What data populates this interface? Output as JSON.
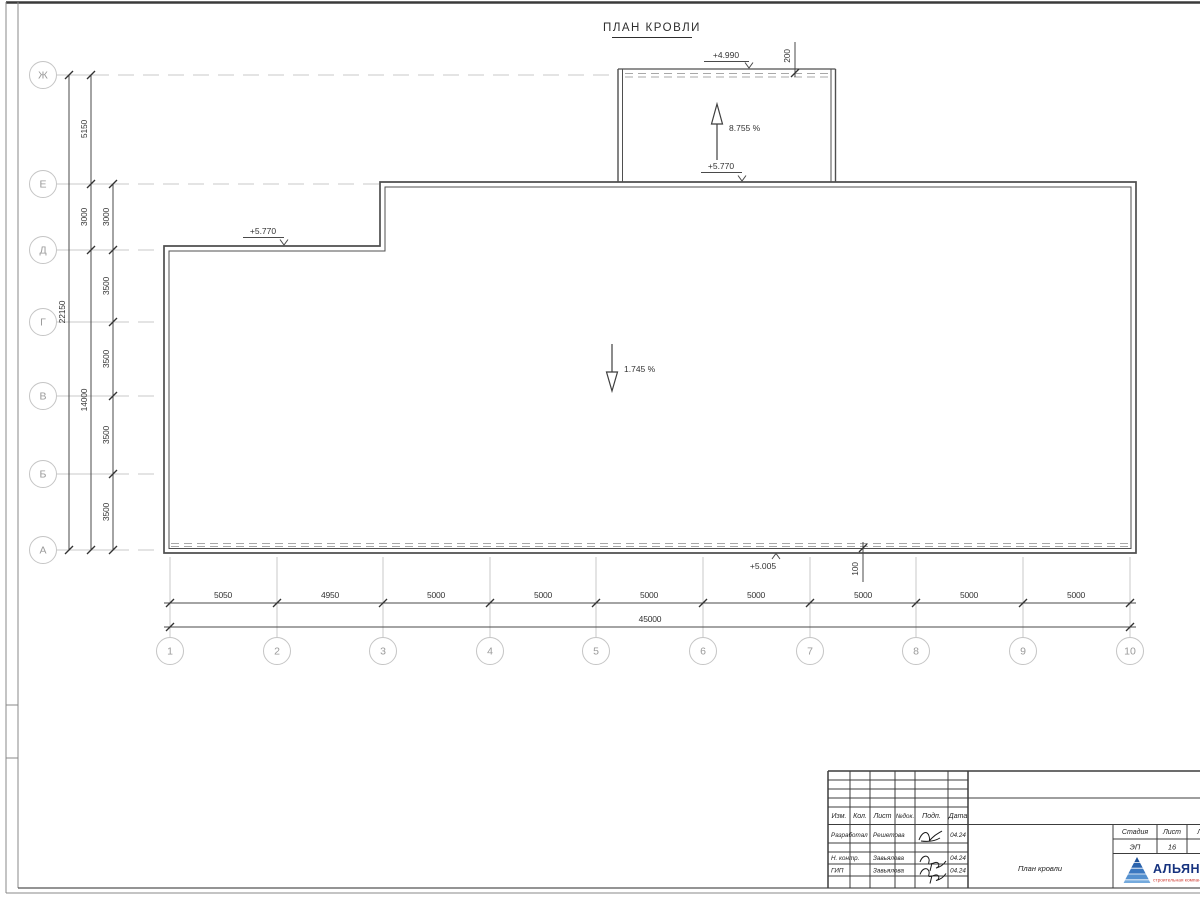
{
  "title": "ПЛАН КРОВЛИ",
  "axis": {
    "rows": [
      "Ж",
      "Е",
      "Д",
      "Г",
      "В",
      "Б",
      "А"
    ],
    "cols": [
      "1",
      "2",
      "3",
      "4",
      "5",
      "6",
      "7",
      "8",
      "9",
      "10"
    ]
  },
  "dims": {
    "bottom": [
      "5050",
      "4950",
      "5000",
      "5000",
      "5000",
      "5000",
      "5000",
      "5000",
      "5000"
    ],
    "bottom_total": "45000",
    "left_total": "22150",
    "left_mid": [
      "5150",
      "3000",
      "14000"
    ],
    "left_inner": [
      "3000",
      "3500",
      "3500",
      "3500",
      "3500"
    ],
    "parapet_top": "200",
    "parapet_bottom": "100"
  },
  "marks": {
    "elev_block_top": "+4.990",
    "elev_block_base": "+5.770",
    "elev_roof_left": "+5.770",
    "elev_roof_bottom": "+5.005",
    "slope_block": "8.755 %",
    "slope_roof": "1.745 %"
  },
  "titleblock": {
    "cols": [
      "Изм.",
      "Кол.",
      "Лист",
      "№док.",
      "Подп.",
      "Дата"
    ],
    "rows": [
      {
        "role": "Разработал",
        "name": "Решетова",
        "date": "04.24"
      },
      {
        "role": "Н. контр.",
        "name": "Завьялова",
        "date": "04.24"
      },
      {
        "role": "ГИП",
        "name": "Завьялова",
        "date": "04.24"
      }
    ],
    "doc_title": "План кровли",
    "stage_label": "Стадия",
    "sheet_label": "Лист",
    "sheets_label": "Листов",
    "stage_value": "ЭП",
    "sheet_value": "16",
    "sheets_value": "1",
    "logo_name": "АЛЬЯНС",
    "logo_tagline": "строительная компания"
  },
  "colors": {
    "logo_blue": "#16337f",
    "logo_red": "#cf3a30",
    "line_dark": "#3c3c3c",
    "grid_gray": "#c8c8c8"
  }
}
